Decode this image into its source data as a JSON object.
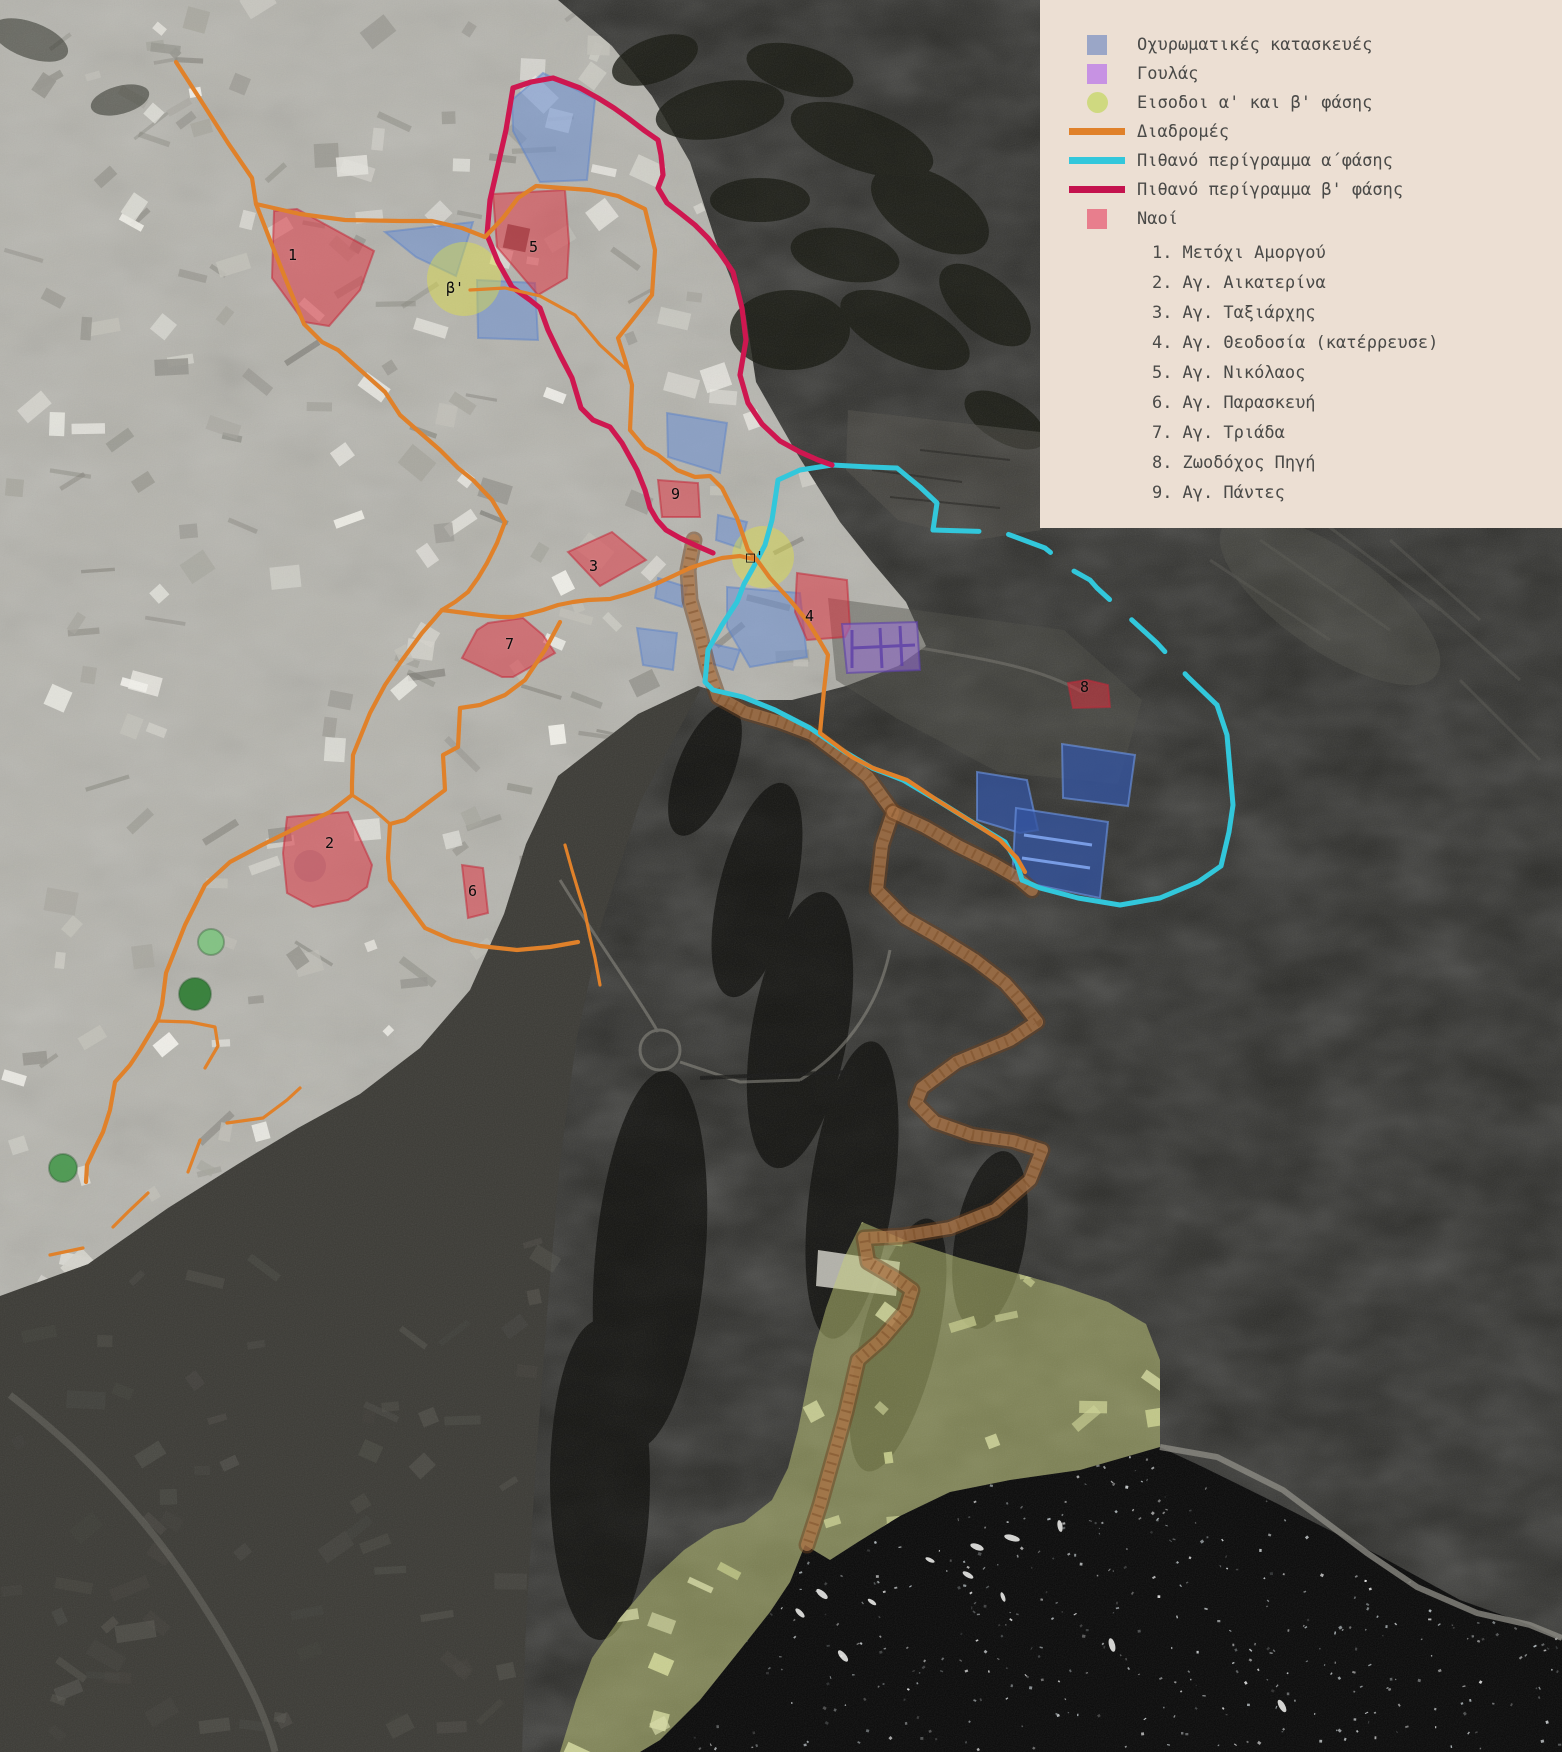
{
  "legend": {
    "items": [
      {
        "label": "Οχυρωματικές κατασκευές",
        "shape": "square",
        "color": "#9AA6C7"
      },
      {
        "label": "Γουλάς",
        "shape": "square",
        "color": "#C792E3"
      },
      {
        "label": "Εισοδοι α' και β' φάσης",
        "shape": "circle",
        "color": "#CFD980"
      },
      {
        "label": "Διαδρομές",
        "shape": "line",
        "color": "#E0812A"
      },
      {
        "label": "Πιθανό περίγραμμα α΄φάσης",
        "shape": "line",
        "color": "#32C7DB"
      },
      {
        "label": "Πιθανό περίγραμμα β' φάσης",
        "shape": "line",
        "color": "#C4134E"
      },
      {
        "label": "Ναοί",
        "shape": "square",
        "color": "#E87E8D"
      }
    ],
    "churches": [
      {
        "num": "1.",
        "name": "Μετόχι Αμοργού"
      },
      {
        "num": "2.",
        "name": "Αγ. Αικατερίνα"
      },
      {
        "num": "3.",
        "name": "Αγ. Ταξιάρχης"
      },
      {
        "num": "4.",
        "name": "Αγ. Θεοδοσία (κατέρρευσε)"
      },
      {
        "num": "5.",
        "name": "Αγ. Νικόλαος"
      },
      {
        "num": "6.",
        "name": "Αγ. Παρασκευή"
      },
      {
        "num": "7.",
        "name": "Αγ. Τριάδα"
      },
      {
        "num": "8.",
        "name": "Ζωοδόχος Πηγή"
      },
      {
        "num": "9.",
        "name": "Αγ. Πάντες"
      }
    ]
  },
  "map": {
    "markers": [
      {
        "label": "1",
        "x": 288,
        "y": 247
      },
      {
        "label": "2",
        "x": 325,
        "y": 835
      },
      {
        "label": "3",
        "x": 589,
        "y": 558
      },
      {
        "label": "4",
        "x": 805,
        "y": 608
      },
      {
        "label": "5",
        "x": 529,
        "y": 239
      },
      {
        "label": "6",
        "x": 468,
        "y": 883
      },
      {
        "label": "7",
        "x": 505,
        "y": 636
      },
      {
        "label": "8",
        "x": 1080,
        "y": 679
      },
      {
        "label": "9",
        "x": 671,
        "y": 486
      },
      {
        "label": "β'",
        "x": 446,
        "y": 280
      },
      {
        "label": "□'",
        "x": 746,
        "y": 549
      }
    ]
  },
  "colors": {
    "panel_bg": "#ECDFD3",
    "text": "#4A4A48",
    "routes": "#E0812A",
    "phase_a_outline": "#32C7DB",
    "phase_b_outline": "#CE1750",
    "church_fill": "rgba(228,48,62,0.5)",
    "fort_fill": "rgba(108,143,212,0.55)",
    "fort_dark_fill": "rgba(52,84,160,0.78)",
    "goulas_fill": "rgba(152,112,214,0.55)",
    "entrance_fill": "rgba(227,227,60,0.42)",
    "path_band": "#BC8352",
    "harbor_tint": "rgba(197,206,120,0.5)"
  }
}
